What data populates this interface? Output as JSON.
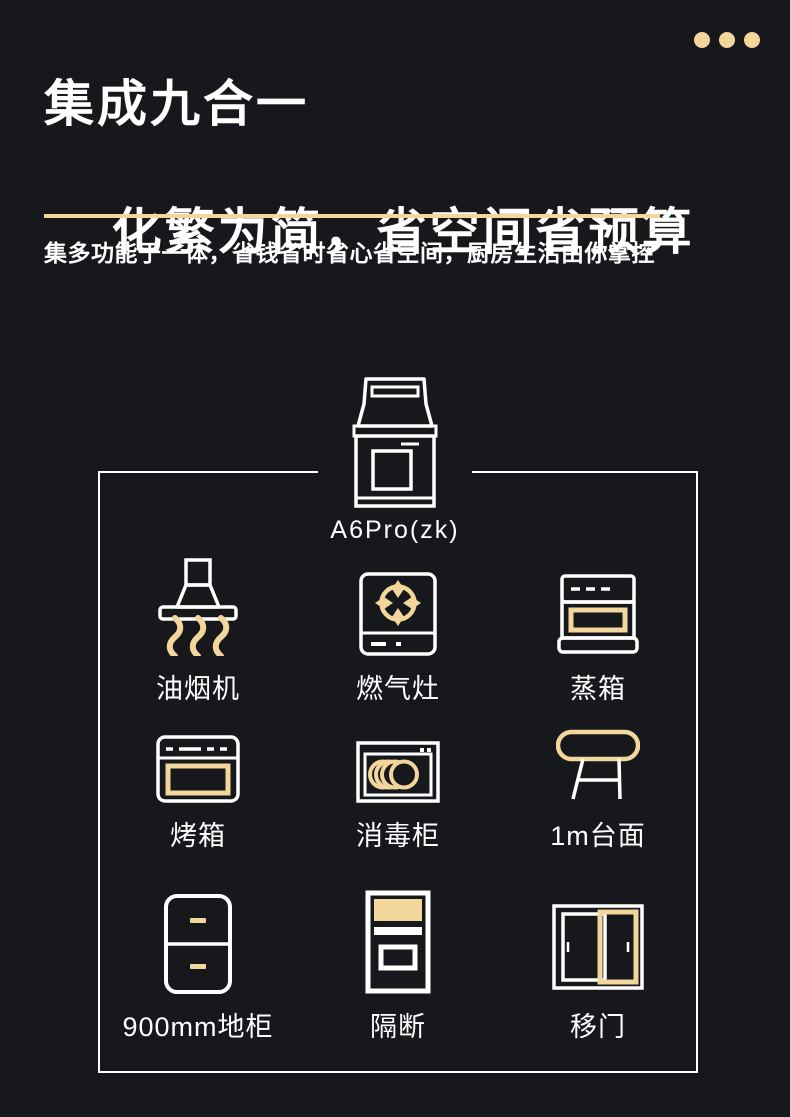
{
  "theme": {
    "background": "#17181C",
    "accent_gold": "#F3D69B",
    "text_color": "#FFFFFF"
  },
  "header": {
    "dots_count": 3,
    "title_line1": "集成九合一",
    "title_line2": "化繁为简，省空间省预算",
    "subtitle": "集多功能于一体，省钱省时省心省空间，厨房生活由你掌控"
  },
  "product": {
    "model": "A6Pro(zk)",
    "icon": "integrated-stove-icon"
  },
  "features": [
    {
      "label": "油烟机",
      "icon": "range-hood-icon"
    },
    {
      "label": "燃气灶",
      "icon": "gas-stove-icon"
    },
    {
      "label": "蒸箱",
      "icon": "steam-oven-icon"
    },
    {
      "label": "烤箱",
      "icon": "oven-icon"
    },
    {
      "label": "消毒柜",
      "icon": "disinfection-cabinet-icon"
    },
    {
      "label": "1m台面",
      "icon": "countertop-icon"
    },
    {
      "label": "900mm地柜",
      "icon": "floor-cabinet-icon"
    },
    {
      "label": "隔断",
      "icon": "partition-icon"
    },
    {
      "label": "移门",
      "icon": "sliding-door-icon"
    }
  ]
}
